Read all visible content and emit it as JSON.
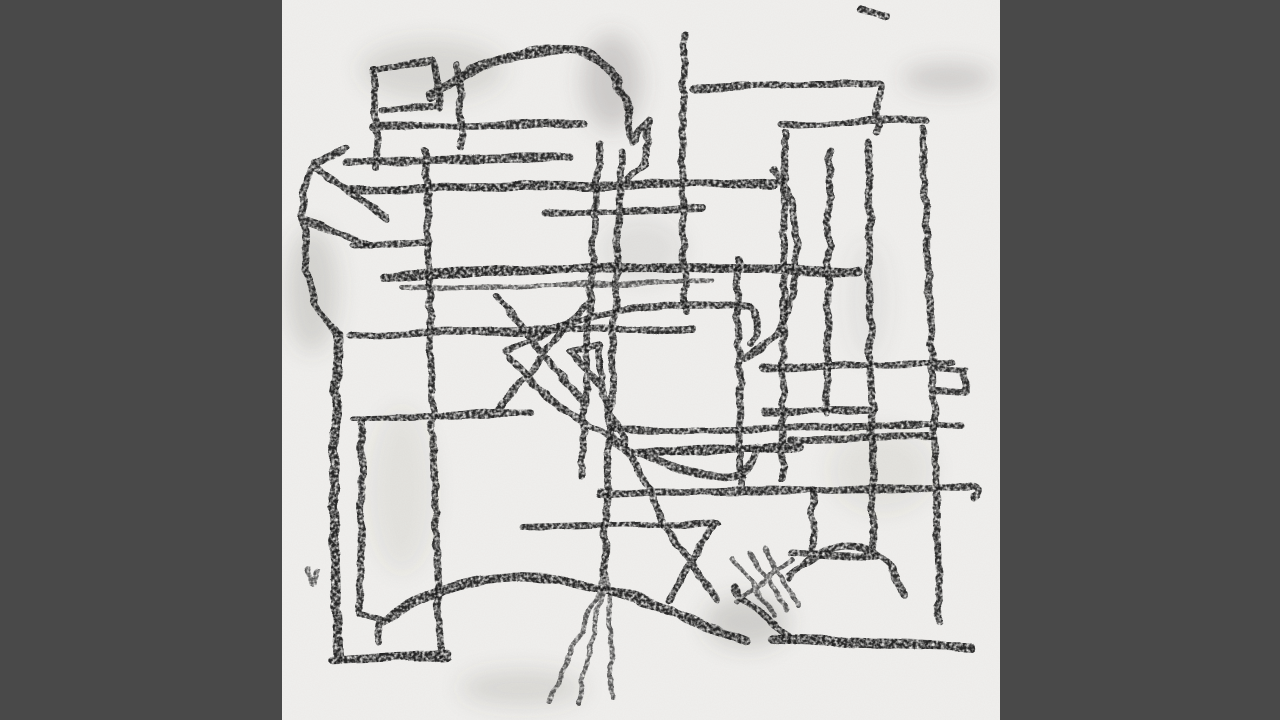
{
  "scene": {
    "type": "abstract artwork still frame",
    "alt_text": "Black-and-white abstract charcoal line drawing on white paper, shown as a square image centered on a dark gray letterbox background"
  },
  "colors": {
    "letterbox": "#494949",
    "paper": "#f1f0ee",
    "stroke": "#1b1b1b",
    "smudge": "#5a5852"
  }
}
